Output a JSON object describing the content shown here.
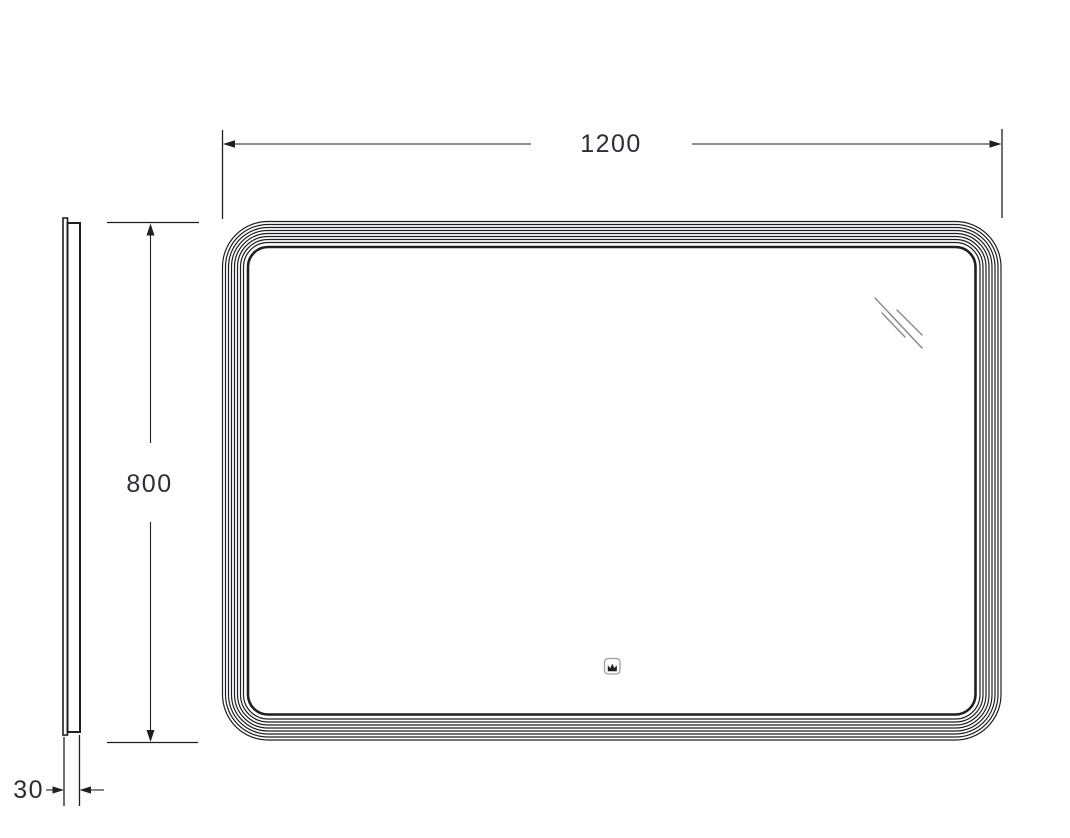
{
  "drawing": {
    "type": "technical-dimension-drawing",
    "front_view": {
      "width_dim": "1200",
      "height_dim": "800",
      "frame_line_count": 9
    },
    "side_view": {
      "depth_dim": "30"
    },
    "icons": {
      "touch_sensor": "crown-touch-sensor-icon",
      "reflection": "glass-reflection-marks"
    },
    "colors": {
      "line": "#1f1f23",
      "dim_text": "#2d2d36",
      "reflection": "#8c8c8c",
      "sensor_border": "#9f9f9f",
      "background": "#ffffff"
    }
  }
}
